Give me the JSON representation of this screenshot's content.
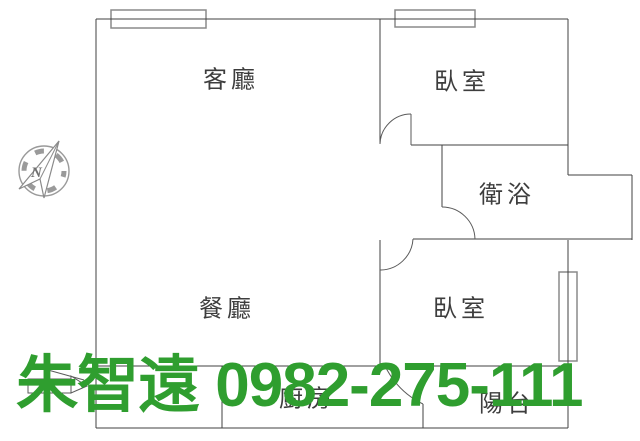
{
  "floor_plan": {
    "rooms": [
      {
        "id": "living-room",
        "label": "客廳"
      },
      {
        "id": "bedroom-top",
        "label": "臥室"
      },
      {
        "id": "bathroom",
        "label": "衛浴"
      },
      {
        "id": "dining-room",
        "label": "餐廳"
      },
      {
        "id": "bedroom-bottom",
        "label": "臥室"
      },
      {
        "id": "kitchen",
        "label": "廚房"
      },
      {
        "id": "balcony",
        "label": "陽台"
      }
    ],
    "compass": {
      "letter": "N"
    }
  },
  "watermark": {
    "name": "朱智遠",
    "phone": "0982-275-111",
    "color": "#2f9e2f"
  },
  "colors": {
    "wall": "#424242",
    "window_frame": "#8a8a8a",
    "label_text": "#3d3d3d",
    "watermark_green": "#2f9e2f"
  }
}
